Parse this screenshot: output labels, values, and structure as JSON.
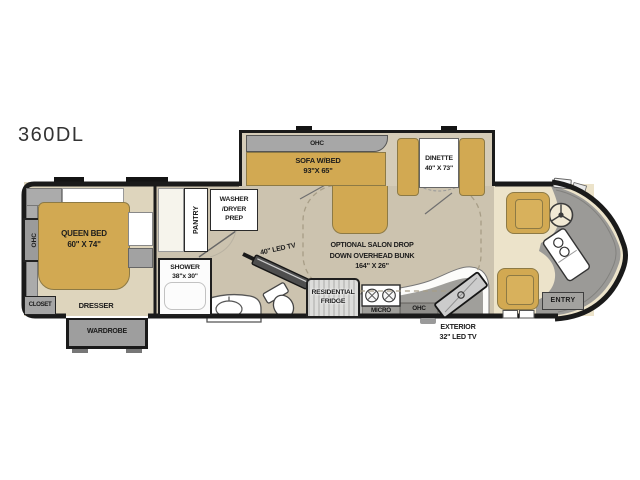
{
  "title": "360DL",
  "bedroom": {
    "ohc": "OHC",
    "closet": "CLOSET",
    "bed_label": "QUEEN BED",
    "bed_size": "60\" X 74\"",
    "dresser": "DRESSER",
    "wardrobe": "WARDROBE"
  },
  "utility": {
    "pantry": "PANTRY",
    "washer_line1": "WASHER",
    "washer_line2": "/DRYER",
    "washer_line3": "PREP"
  },
  "bath": {
    "shower_label": "SHOWER",
    "shower_size": "38\"x 30\"",
    "tv_label": "40\" LED TV"
  },
  "living": {
    "ohc": "OHC",
    "sofa_label": "SOFA W/BED",
    "sofa_size": "93\"X 65\"",
    "dinette_label": "DINETTE",
    "dinette_size": "40\" X 73\"",
    "bunk_line1": "OPTIONAL SALON DROP",
    "bunk_line2": "DOWN OVERHEAD BUNK",
    "bunk_line3": "164\" X 26\""
  },
  "kitchen": {
    "fridge_line1": "RESIDENTIAL",
    "fridge_line2": "FRIDGE",
    "micro": "MICRO",
    "ohc": "OHC",
    "ext_tv_line1": "EXTERIOR",
    "ext_tv_line2": "32\" LED TV"
  },
  "front": {
    "entry": "ENTRY"
  },
  "colors": {
    "furniture_yellow": "#d2a952",
    "floor_bedroom": "#ded5bd",
    "floor_main": "#ccc3af",
    "floor_cab": "#ece3ca",
    "cabinet_gray": "#a5a5a5",
    "dash_gray": "#9b9a97",
    "wall_black": "#1a1a1a"
  }
}
